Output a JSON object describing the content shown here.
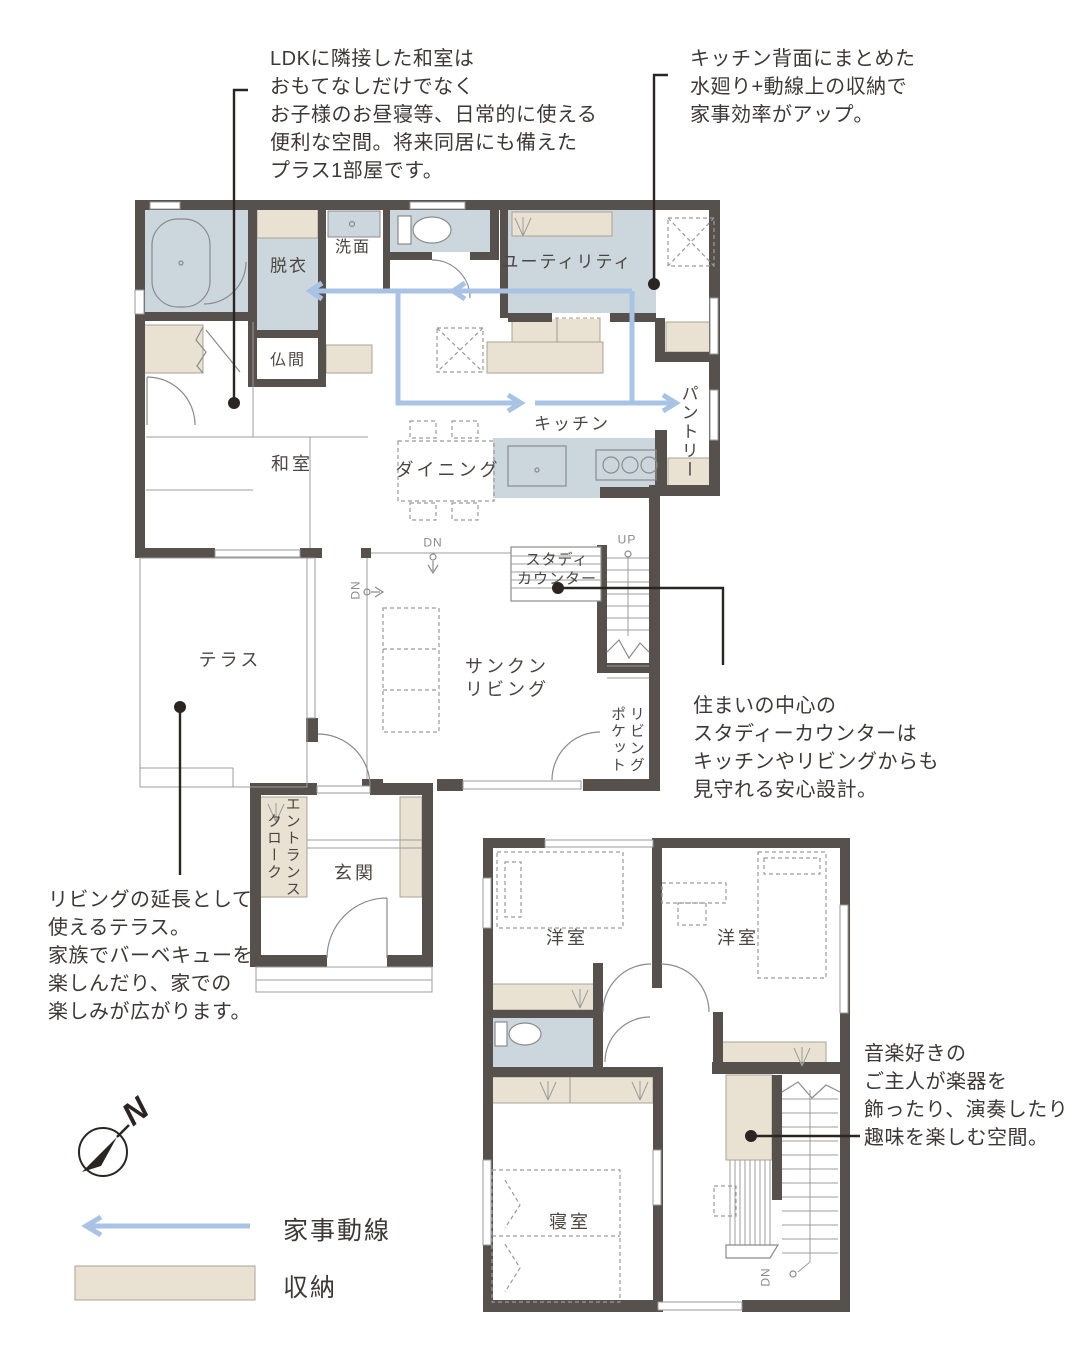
{
  "colors": {
    "wall": "#57514d",
    "water": "#ccd6dd",
    "storage": "#e9e2d2",
    "flow": "#a9c3e4",
    "leader": "#2b2522"
  },
  "annotations": {
    "washitsu": {
      "text": "LDKに隣接した和室は\nおもてなしだけでなく\nお子様のお昼寝等、日常的に使える\n便利な空間。将来同居にも備えた\nプラス1部屋です。"
    },
    "mizumawari": {
      "text": "キッチン背面にまとめた\n水廻り+動線上の収納で\n家事効率がアップ。"
    },
    "study": {
      "text": "住まいの中心の\nスタディーカウンターは\nキッチンやリビングからも\n見守れる安心設計。"
    },
    "terrace": {
      "text": "リビングの延長として\n使えるテラス。\n家族でバーベキューを\n楽しんだり、家での\n楽しみが広がります。"
    },
    "music": {
      "text": "音楽好きの\nご主人が楽器を\n飾ったり、演奏したり\n趣味を楽しむ空間。"
    }
  },
  "floor1": {
    "rooms": {
      "senmen": "洗面",
      "datsui": "脱衣",
      "butsuma": "仏間",
      "washitsu": "和室",
      "utility": "ユーティリティ",
      "pantry": "パントリー",
      "kitchen": "キッチン",
      "dining": "ダイニング",
      "study_counter": "スタディ\nカウンター",
      "sunken_living": "サンクン\nリビング",
      "terrace": "テラス",
      "living_pocket": "リビング\nポケット",
      "entrance_cloak": "エントランス\nクローク",
      "genkan": "玄関"
    },
    "marks": {
      "dn": "DN",
      "up": "UP"
    }
  },
  "floor2": {
    "rooms": {
      "yoshitsu_left": "洋室",
      "yoshitsu_right": "洋室",
      "shinshitsu": "寝室"
    },
    "marks": {
      "dn": "DN"
    }
  },
  "legend": {
    "north": "N",
    "flow_label": "家事動線",
    "storage_label": "収納"
  }
}
